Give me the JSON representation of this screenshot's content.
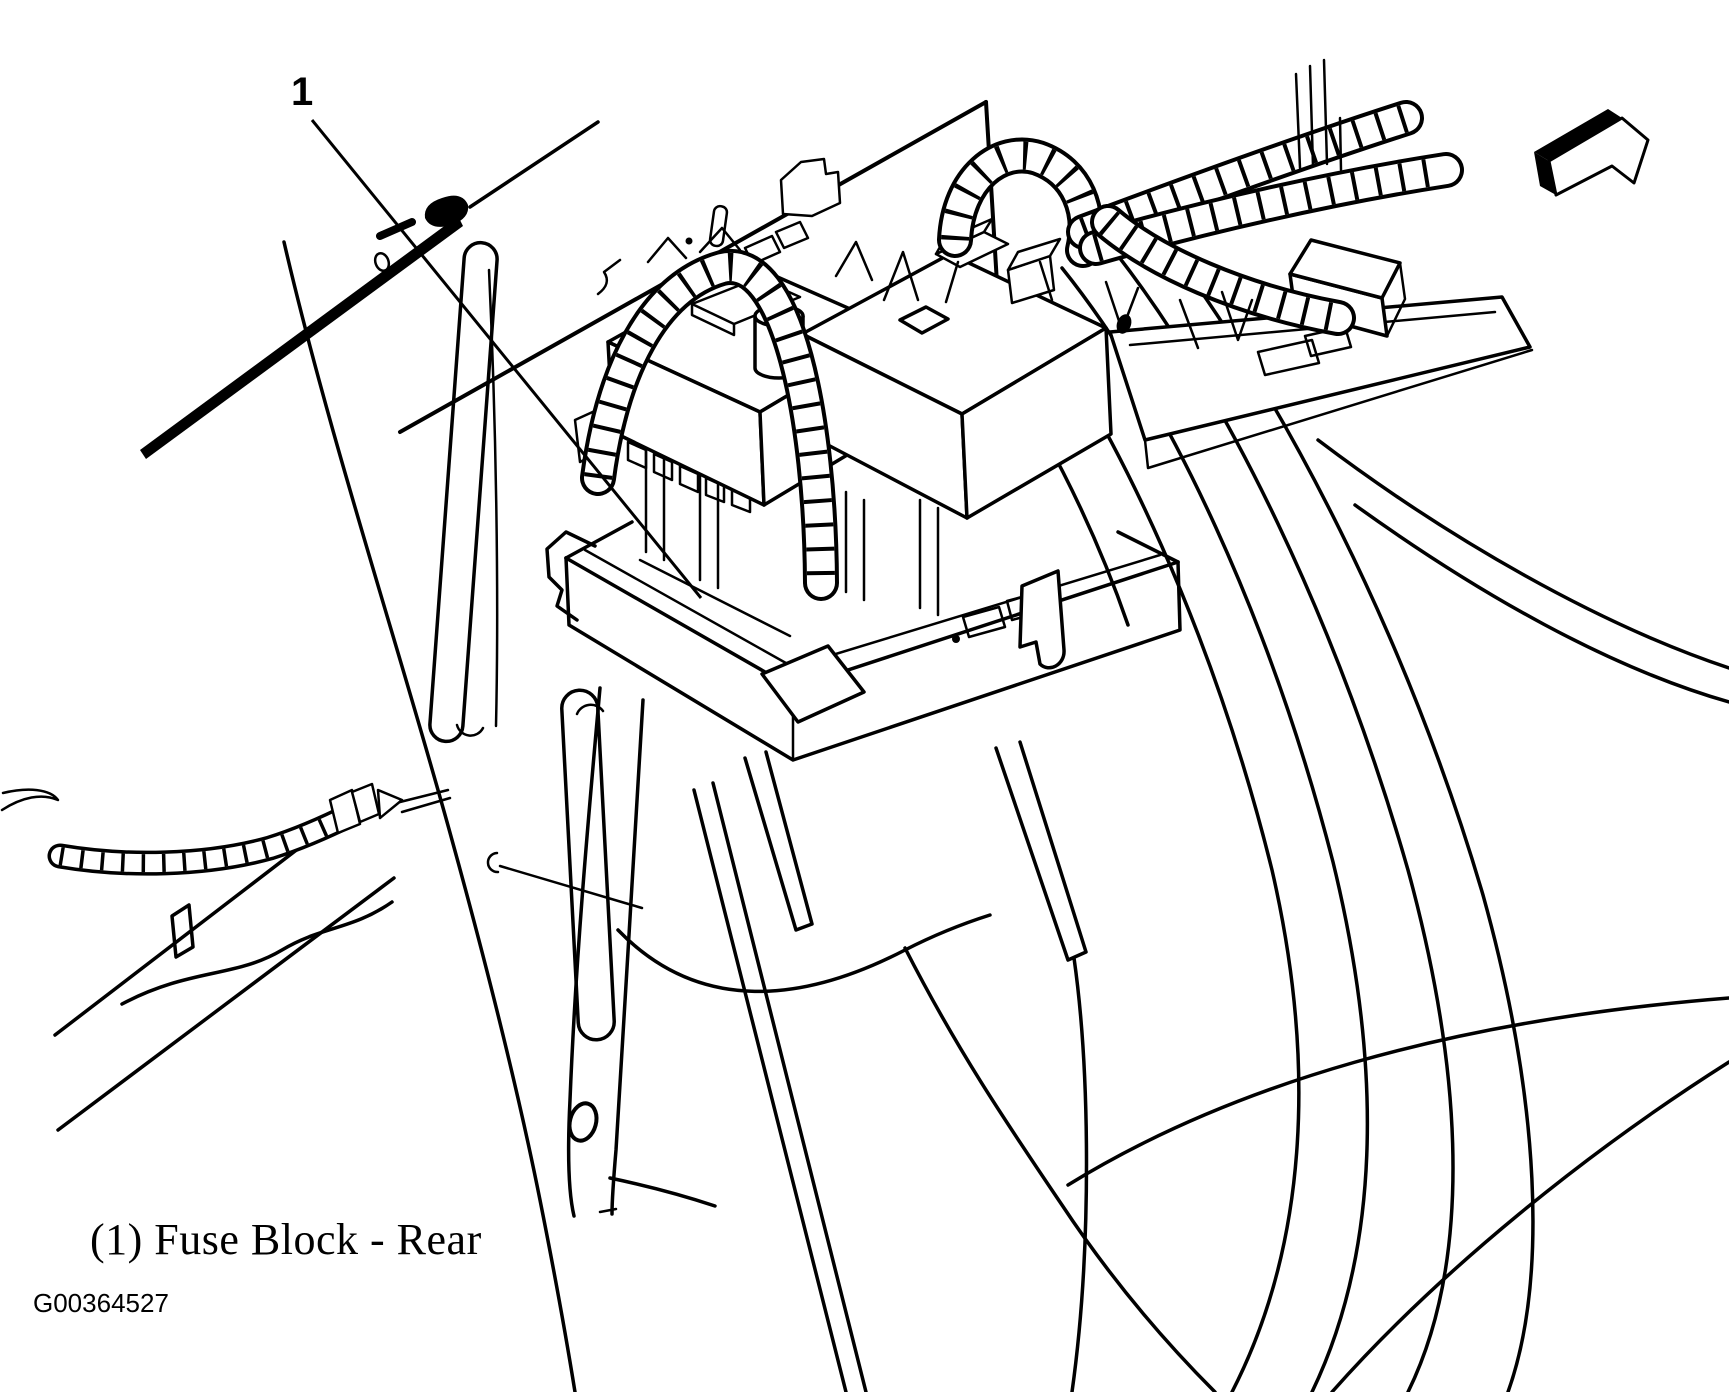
{
  "figure": {
    "callout_number": "1",
    "caption": "(1) Fuse Block - Rear",
    "figure_id": "G00364527"
  },
  "illustration": {
    "kind": "service-manual line drawing",
    "subject": "Rear fuse block location in vehicle rear quarter body structure",
    "labeled_parts": [
      {
        "number": "1",
        "name": "Fuse Block - Rear"
      }
    ],
    "colors": {
      "line": "#000000",
      "background": "#ffffff"
    }
  }
}
